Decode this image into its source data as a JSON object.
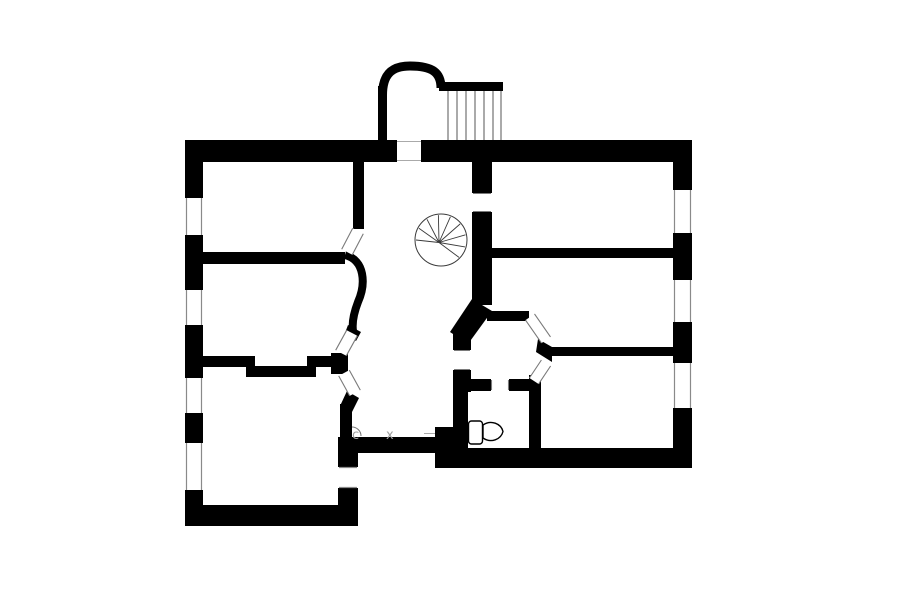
{
  "page": {
    "background_color": "#ffffff",
    "ink_color": "#000000",
    "detail_line_color": "#8a8a8a",
    "label_color": "#9f9f9f"
  },
  "plan": {
    "type": "architectural floor plan, black walls on white",
    "labels": {
      "c": "c",
      "x": "x"
    },
    "fixtures": [
      "spiral-staircase",
      "exterior-staircase",
      "arched-porch",
      "toilet"
    ],
    "openings": {
      "entry_door": 1,
      "interior_cased_openings": 4,
      "diagonal_doorways": 5
    },
    "windows": {
      "left_wall": 4,
      "right_wall": 3
    },
    "rooms_count": 8
  }
}
